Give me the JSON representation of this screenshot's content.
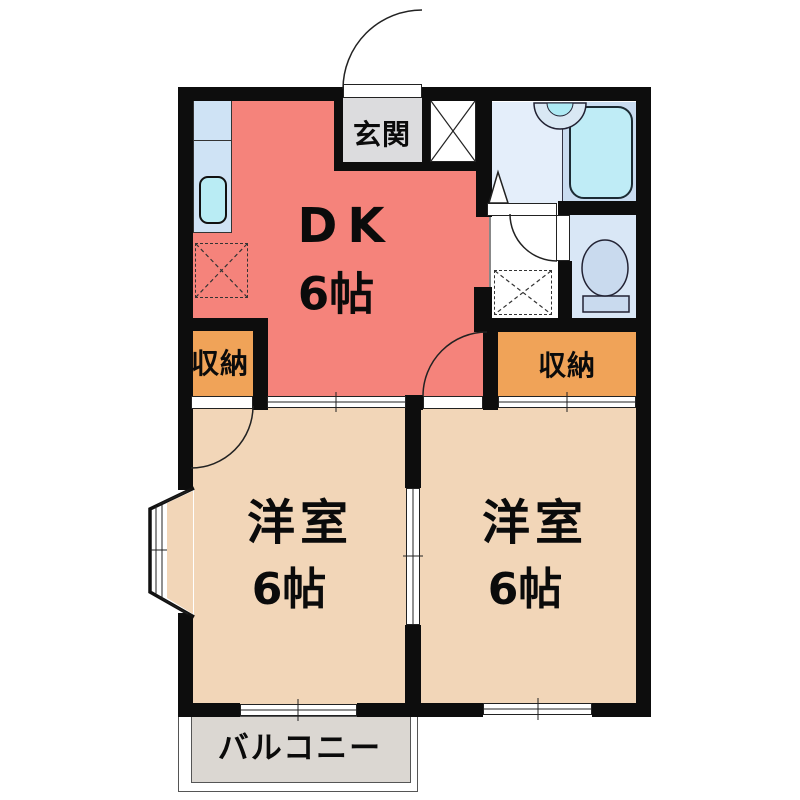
{
  "type": "floor-plan",
  "labels": {
    "dk": {
      "name": "DK",
      "size": "6帖"
    },
    "genkan": "玄関",
    "closet_left": "収納",
    "closet_right": "収納",
    "room_left": {
      "name": "洋室",
      "size": "6帖"
    },
    "room_right": {
      "name": "洋室",
      "size": "6帖"
    },
    "balcony": "バルコニー"
  },
  "fixtures": [
    "kitchen-counter",
    "kitchen-sink",
    "refrigerator-space",
    "entrance-door",
    "shoe-cabinet",
    "washbasin",
    "bathtub",
    "washing-machine-space",
    "toilet",
    "bay-window",
    "sliding-door",
    "hinged-door"
  ],
  "colors": {
    "dk": "#f5837b",
    "western_room": "#f2d6b8",
    "closet": "#f0a358",
    "genkan": "#dcdcde",
    "balcony": "#dbd7d2",
    "washroom": "#e4eefa",
    "bath": "#c9dcf0",
    "bathtub": "#bfecf6",
    "toilet_room": "#d9e7f6",
    "kitchen_counter": "#cfe3f5",
    "sink": "#b9ecf4",
    "wall": "#0d0d0d"
  }
}
